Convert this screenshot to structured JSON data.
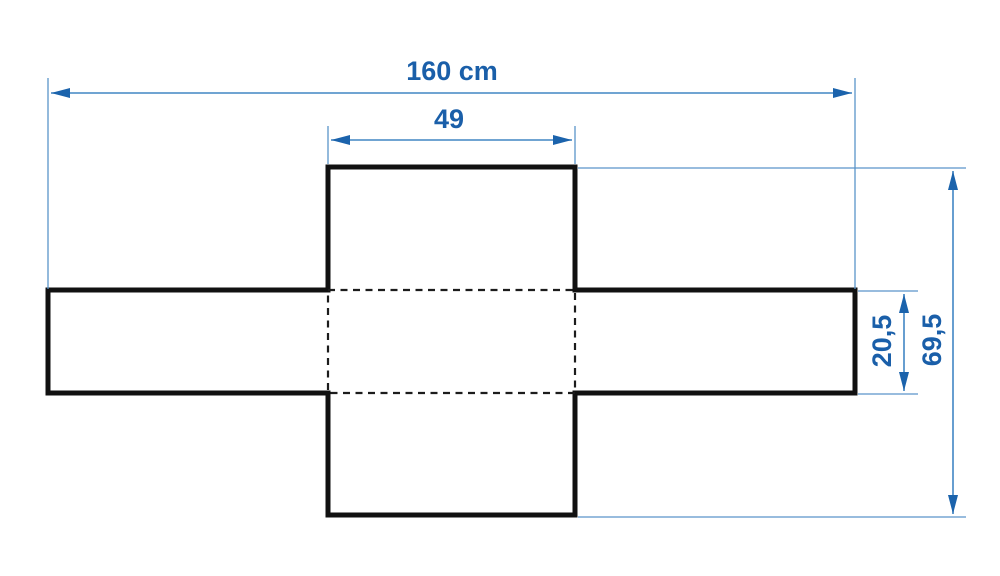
{
  "diagram": {
    "type": "dimension-drawing",
    "subject": "cross-shaped-cover-pattern",
    "dimensions": {
      "total_width": {
        "label": "160 cm",
        "value": "160",
        "unit": "cm"
      },
      "center_width": {
        "label": "49",
        "value": "49"
      },
      "band_height": {
        "label": "20,5",
        "value": "20,5"
      },
      "total_height": {
        "label": "69,5",
        "value": "69,5"
      }
    },
    "colors": {
      "dimension_line": "#4186c4",
      "dimension_arrow": "#1b63ac",
      "dimension_text": "#1a5fa9",
      "outline": "#111111",
      "fold_line": "#1c1c1c",
      "background": "#ffffff"
    }
  }
}
